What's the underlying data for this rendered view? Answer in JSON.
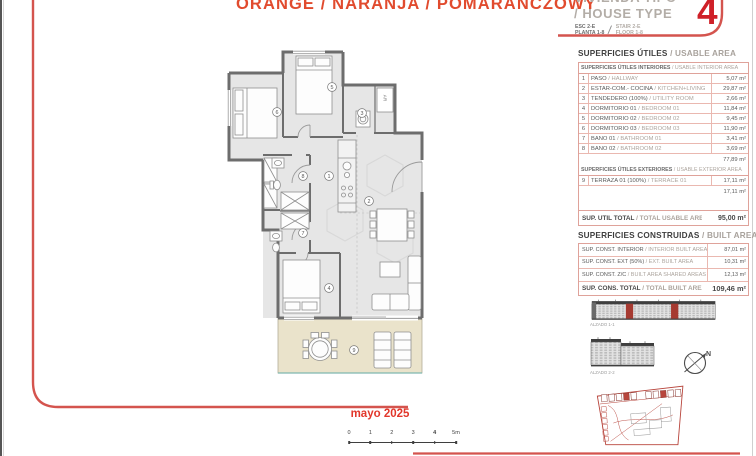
{
  "title": "ORANGE / NARANJA / POMARAŃCZOWY",
  "house_type": {
    "label_es": "VIVIENDA TIPO",
    "label_en": "/ HOUSE TYPE",
    "number": "4",
    "esc_es": "ESC 2-E",
    "planta_es": "PLANTA 1-8",
    "esc_en": "STAIR 2-E",
    "planta_en": "FLOOR 1-8",
    "slash": "/"
  },
  "usable": {
    "heading_es": "SUPERFICIES ÚTILES",
    "heading_en": "/ USABLE AREA",
    "interior_header_es": "SUPERFICIES ÚTILES INTERIORES",
    "interior_header_en": "/ USABLE INTERIOR AREA",
    "interior_rows": [
      {
        "num": "1",
        "es": "PASO",
        "en": "/ HALLWAY",
        "value": "5,07 m²"
      },
      {
        "num": "2",
        "es": "ESTAR-COM.- COCINA",
        "en": "/ KITCHEN+LIVING",
        "value": "29,87 m²"
      },
      {
        "num": "3",
        "es": "TENDEDERO (100%)",
        "en": "/ UTILITY ROOM",
        "value": "2,66 m²"
      },
      {
        "num": "4",
        "es": "DORMITORIO 01",
        "en": "/ BEDROOM 01",
        "value": "11,84 m²"
      },
      {
        "num": "5",
        "es": "DORMITORIO 02",
        "en": "/ BEDROOM 02",
        "value": "9,45 m²"
      },
      {
        "num": "6",
        "es": "DORMITORIO 03",
        "en": "/ BEDROOM 03",
        "value": "11,90 m²"
      },
      {
        "num": "7",
        "es": "BAÑO 01",
        "en": "/ BATHROOM 01",
        "value": "3,41 m²"
      },
      {
        "num": "8",
        "es": "BAÑO 02",
        "en": "/ BATHROOM 02",
        "value": "3,69 m²"
      }
    ],
    "interior_subtotal": "77,89 m²",
    "exterior_header_es": "SUPERFICIES ÚTILES EXTERIORES",
    "exterior_header_en": "/ USABLE EXTERIOR AREA",
    "exterior_rows": [
      {
        "num": "9",
        "es": "TERRAZA 01 (100%)",
        "en": "/ TERRACE 01",
        "value": "17,11 m²"
      }
    ],
    "exterior_subtotal": "17,11 m²",
    "total_es": "SUP. ÚTIL TOTAL",
    "total_en": "/ TOTAL USABLE AREA",
    "total_value": "95,00 m²"
  },
  "built": {
    "heading_es": "SUPERFICIES CONSTRUIDAS",
    "heading_en": "/ BUILT AREA",
    "rows": [
      {
        "es": "SUP. CONST. INTERIOR",
        "en": "/ INTERIOR BUILT AREA",
        "value": "87,01 m²"
      },
      {
        "es": "SUP. CONST. EXT (50%)",
        "en": "/ EXT. BUILT AREA",
        "value": "10,31 m²"
      },
      {
        "es": "SUP. CONST. Z/C",
        "en": "/ BUILT AREA SHARED AREAS",
        "value": "12,13 m²"
      }
    ],
    "total": {
      "es": "SUP. CONS. TOTAL",
      "en": "/ TOTAL BUILT AREA",
      "value": "109,46 m²"
    }
  },
  "elevations": [
    {
      "label": "ALZADO 1-1"
    },
    {
      "label": "ALZADO 2-2"
    }
  ],
  "compass_label": "N",
  "plan": {
    "ar_label": "AR",
    "rooms": [
      {
        "num": "1",
        "x": 329,
        "y": 176
      },
      {
        "num": "2",
        "x": 369,
        "y": 201
      },
      {
        "num": "3",
        "x": 362,
        "y": 113
      },
      {
        "num": "4",
        "x": 329,
        "y": 288
      },
      {
        "num": "5",
        "x": 332,
        "y": 87
      },
      {
        "num": "6",
        "x": 277,
        "y": 112
      },
      {
        "num": "7",
        "x": 303,
        "y": 233
      },
      {
        "num": "8",
        "x": 303,
        "y": 176
      },
      {
        "num": "9",
        "x": 354,
        "y": 350
      }
    ]
  },
  "date": "mayo 2025",
  "scale": {
    "ticks": [
      "0",
      "1",
      "2",
      "3",
      "4",
      "5m"
    ],
    "bold_index": 4
  },
  "colors": {
    "accent_red": "#cf2028",
    "frame_red": "#d4544e",
    "title_orange": "#e14b2e",
    "table_pink": "#dfa29a",
    "terrace": "#eae3cb"
  }
}
